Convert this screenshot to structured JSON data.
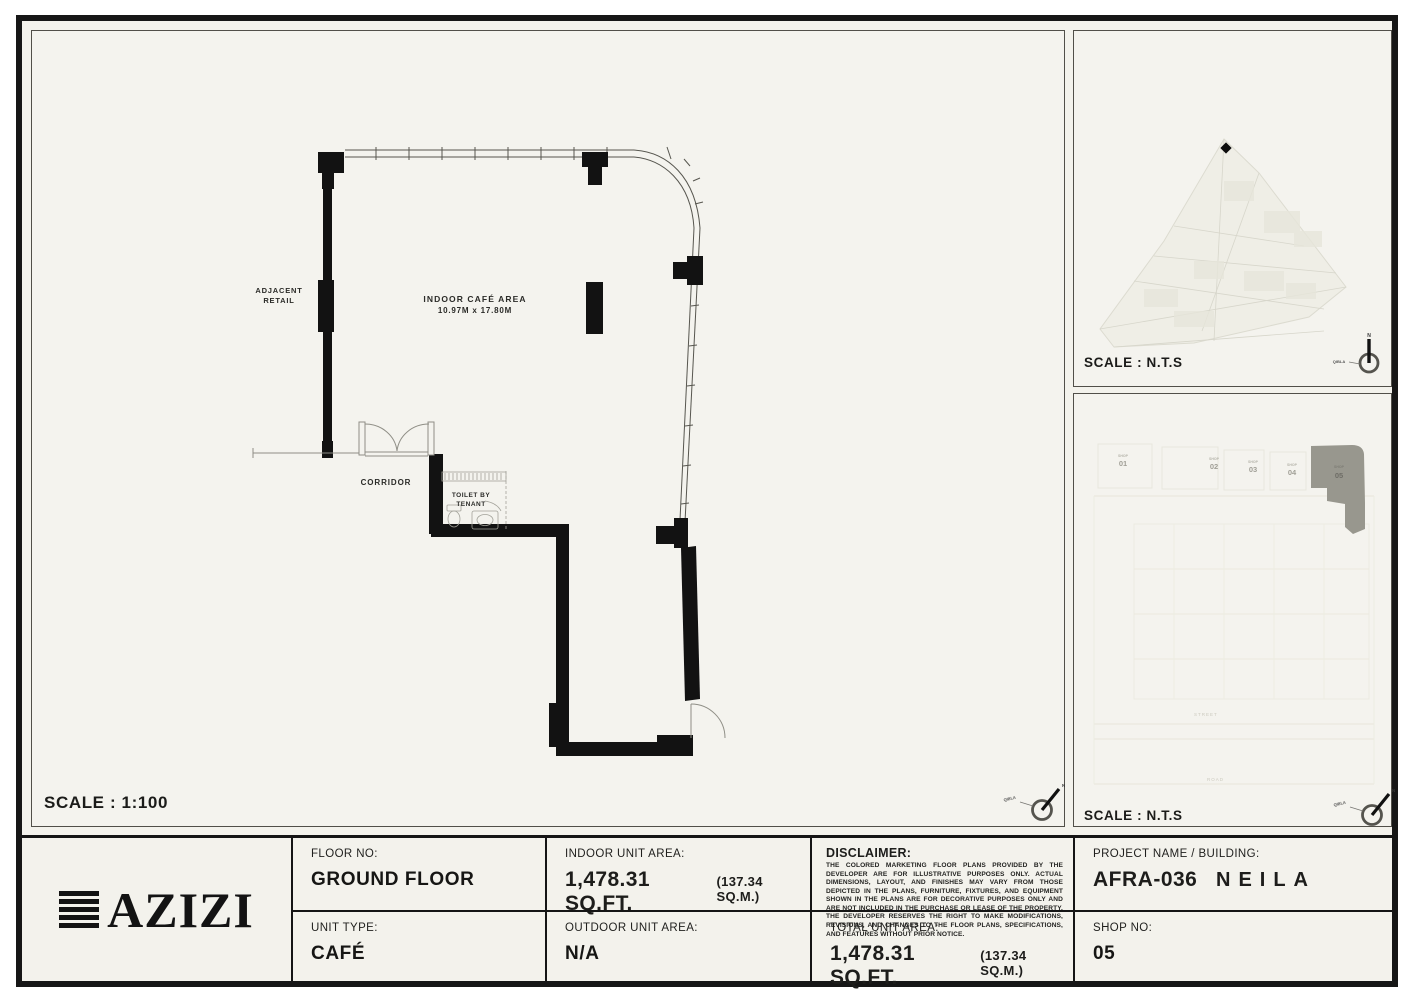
{
  "page": {
    "background": "#f3f2ec",
    "frame_color": "#161616"
  },
  "main_panel": {
    "scale_label": "SCALE : 1:100",
    "labels": {
      "indoor_area_title": "INDOOR CAFÉ AREA",
      "indoor_area_dims": "10.97M x 17.80M",
      "adjacent_line1": "ADJACENT",
      "adjacent_line2": "RETAIL",
      "corridor": "CORRIDOR",
      "toilet_line1": "TOILET BY",
      "toilet_line2": "TENANT"
    },
    "compass": {
      "north": "N",
      "qibla": "QIBLA"
    }
  },
  "location_map_panel": {
    "scale_label": "SCALE : N.T.S",
    "compass": {
      "north": "N",
      "qibla": "QIBLA"
    }
  },
  "site_plan_panel": {
    "scale_label": "SCALE : N.T.S",
    "compass": {
      "north": "N",
      "qibla": "QIBLA"
    },
    "highlight_color": "#98978e",
    "units": [
      {
        "shop": "SHOP",
        "number": "01"
      },
      {
        "shop": "SHOP",
        "number": "02"
      },
      {
        "shop": "SHOP",
        "number": "03"
      },
      {
        "shop": "SHOP",
        "number": "04"
      },
      {
        "shop": "SHOP",
        "number": "05"
      }
    ],
    "street_label": "STREET",
    "road_label": "ROAD"
  },
  "title_block": {
    "logo_text": "AZIZI",
    "floor": {
      "label": "FLOOR NO:",
      "value": "GROUND FLOOR"
    },
    "unit_type": {
      "label": "UNIT TYPE:",
      "value": "CAFÉ"
    },
    "indoor_area": {
      "label": "INDOOR UNIT AREA:",
      "value": "1,478.31 SQ.FT.",
      "secondary": "(137.34 SQ.M.)"
    },
    "outdoor_area": {
      "label": "OUTDOOR UNIT AREA:",
      "value": "N/A"
    },
    "disclaimer": {
      "label": "DISCLAIMER:",
      "body": "THE COLORED MARKETING FLOOR PLANS PROVIDED BY THE DEVELOPER ARE FOR ILLUSTRATIVE PURPOSES ONLY. ACTUAL DIMENSIONS, LAYOUT, AND FINISHES MAY VARY FROM THOSE DEPICTED IN THE PLANS, FURNITURE, FIXTURES, AND EQUIPMENT SHOWN IN THE PLANS ARE FOR DECORATIVE PURPOSES ONLY AND ARE NOT INCLUDED IN THE PURCHASE OR LEASE OF THE PROPERTY. THE DEVELOPER RESERVES THE RIGHT TO MAKE MODIFICATIONS, REVISIONS, AND CHANGES TO THE FLOOR PLANS, SPECIFICATIONS, AND FEATURES WITHOUT PRIOR NOTICE."
    },
    "total_area": {
      "label": "TOTAL UNIT AREA:",
      "value": "1,478.31 SQ.FT.",
      "secondary": "(137.34 SQ.M.)"
    },
    "project": {
      "label": "PROJECT NAME / BUILDING:",
      "value": "AFRA-036",
      "building": "NEILA"
    },
    "shop": {
      "label": "SHOP NO:",
      "value": "05"
    }
  }
}
